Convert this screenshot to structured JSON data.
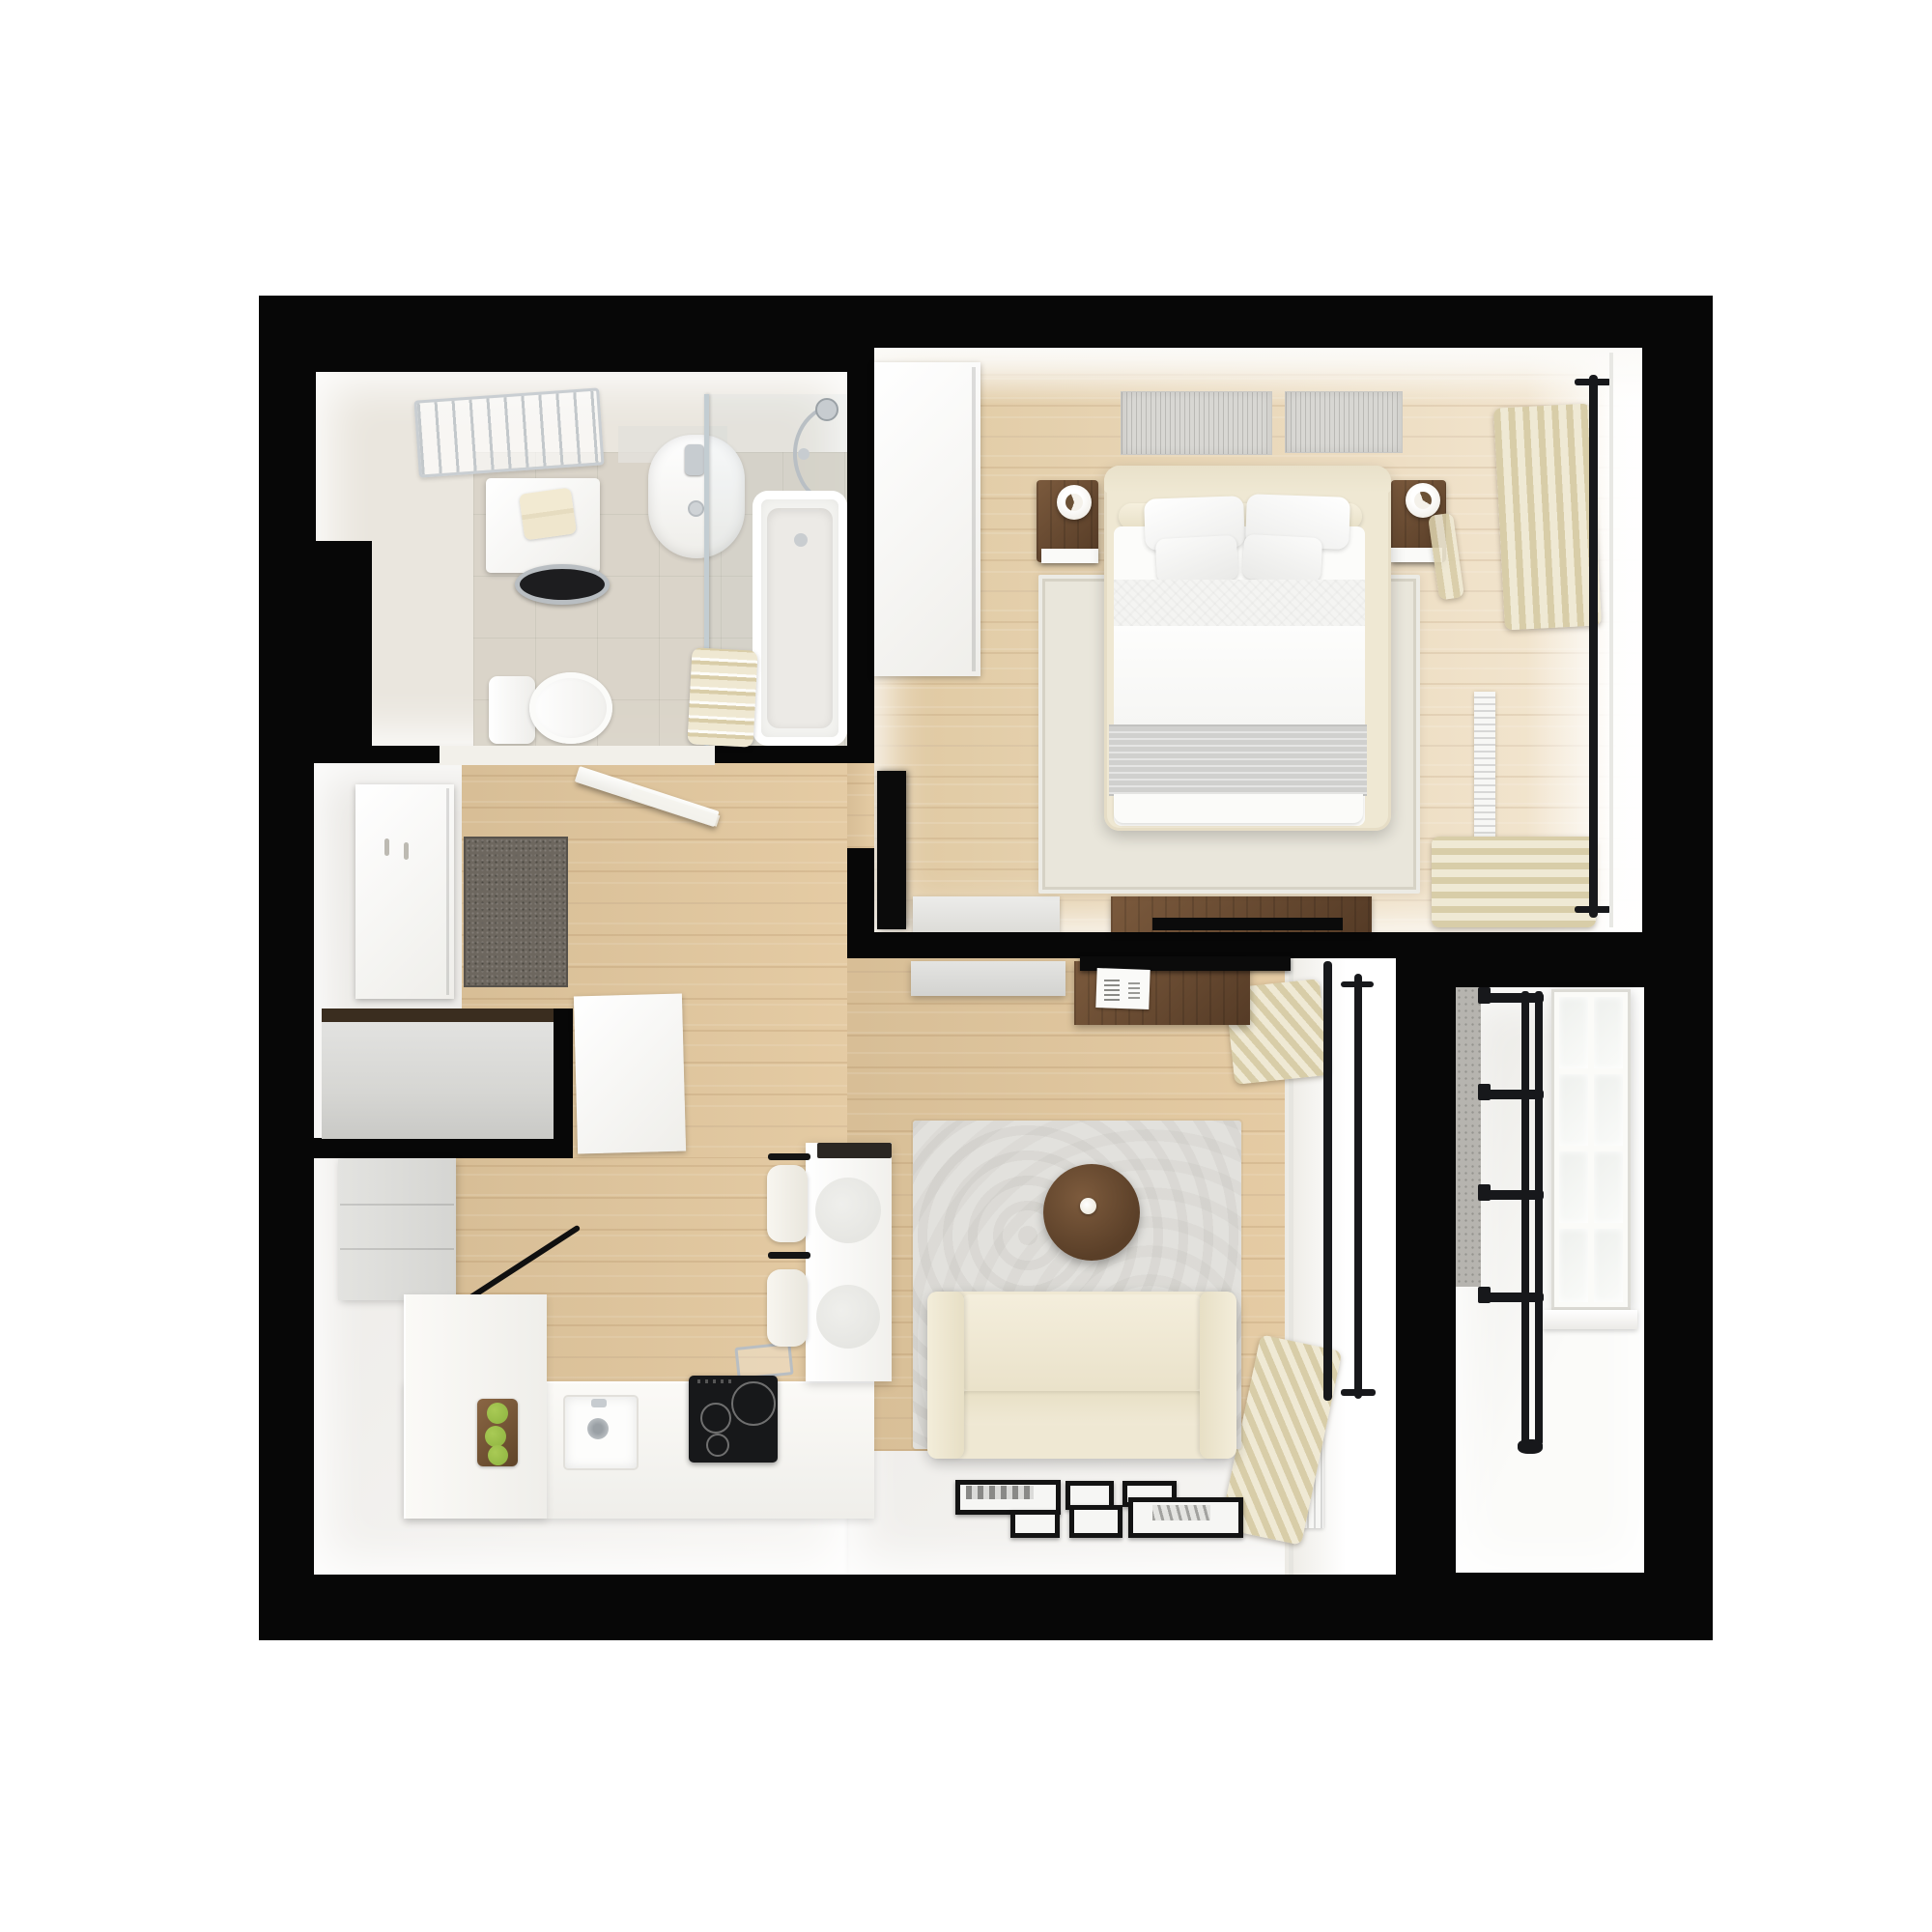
{
  "scene": {
    "kind": "apartment-floor-plan-top-down-3d-render",
    "background": "#ffffff",
    "no_visible_text": true
  },
  "palette": {
    "wall": "#070707",
    "wood": "#e3c89e",
    "woodBedroom": "#e7cfa6",
    "whiteFloor": "#f1efeb",
    "tileFloor": "#d9d3c7",
    "bathWall": "#eae6de",
    "cream": "#efe8d3",
    "creamDark": "#e0d6ba",
    "walnut": "#6e4f35",
    "walnutDark": "#3a2d1f",
    "grayRug": "#e2e1dd",
    "bedroomRug": "#e9e6db",
    "curtain": "#d8cda8",
    "curtainLight": "#efe9d4",
    "grayFront": "#d6d6d3",
    "doormat": "#6d675f",
    "concrete": "#b6b4af",
    "metalBlack": "#17181b",
    "chrome": "#c7ccd0",
    "apple": "#8db33f",
    "blanketGray": "#d0d0ce",
    "ventGray": "#d8d7d3",
    "panelWhite": "#f7f7f5",
    "tvBlack": "#0b0b0b"
  },
  "rooms": {
    "bathroom": {
      "name": "bathroom",
      "items": [
        "towel-radiator",
        "washing-machine",
        "folded-towels",
        "wash-basin",
        "shower-glass-screen",
        "shower-hose",
        "bathtub",
        "toilet",
        "striped-towels",
        "tile-floor"
      ]
    },
    "hallway": {
      "name": "entry-hall",
      "items": [
        "entry-door",
        "doormat",
        "wardrobe",
        "shoe-cabinet-walnut-top",
        "tall-white-cabinet"
      ]
    },
    "kitchen": {
      "name": "kitchen",
      "items": [
        "tall-cabinet-column",
        "oven-handle",
        "l-shaped-counter",
        "kitchen-sink",
        "induction-cooktop",
        "pan-rack",
        "apple-tray",
        "dining-table",
        "two-round-chairs",
        "black-serving-tray"
      ]
    },
    "living": {
      "name": "living-room",
      "items": [
        "wall-shelf",
        "media-console",
        "art-book",
        "flat-tv",
        "area-rug",
        "round-coffee-table",
        "candle",
        "cream-sofa",
        "six-picture-frames",
        "radiator",
        "curtain-rods",
        "curtains",
        "window-bay"
      ]
    },
    "bedroom": {
      "name": "bedroom",
      "items": [
        "ceiling-vents",
        "wardrobe",
        "wall-tv",
        "low-bench",
        "media-console",
        "double-bed",
        "four-pillows",
        "gray-blanket",
        "two-nightstands",
        "two-lamps",
        "area-rug",
        "radiator",
        "curtain-rod",
        "curtains",
        "window-bay"
      ]
    },
    "balcony": {
      "name": "balcony",
      "items": [
        "concrete-wall-strip",
        "black-metal-railing",
        "french-window-grid",
        "window-sill"
      ]
    }
  }
}
